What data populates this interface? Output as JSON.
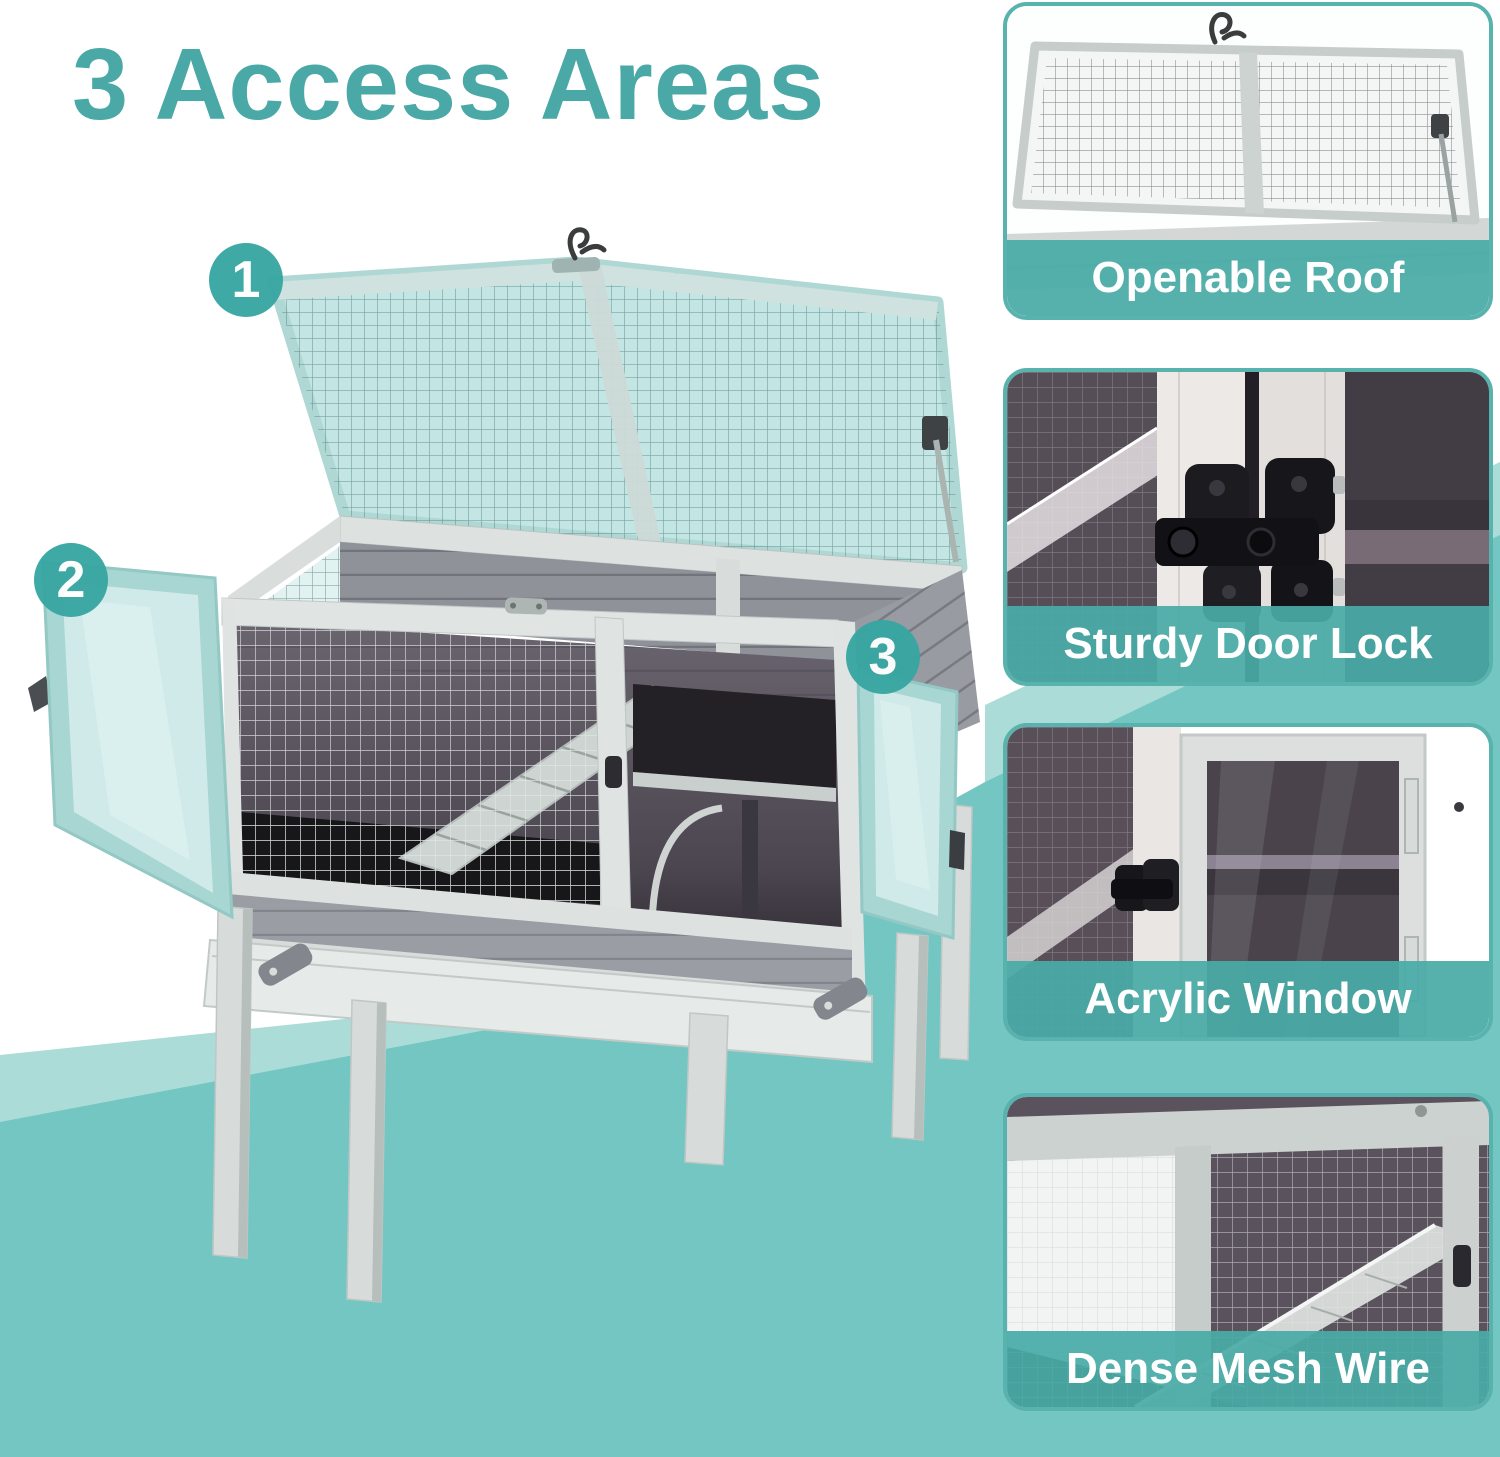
{
  "title": {
    "text": "3 Access Areas"
  },
  "badges": [
    "1",
    "2",
    "3"
  ],
  "features": [
    {
      "label": "Openable Roof"
    },
    {
      "label": "Sturdy Door Lock"
    },
    {
      "label": "Acrylic Window"
    },
    {
      "label": "Dense Mesh Wire"
    }
  ],
  "colors": {
    "accent_teal": "#4aa9a6",
    "badge_teal": "#38a6a2",
    "caption_bar_teal": "#49aba7",
    "background_light_teal": "#abdcd8",
    "background_medium_teal": "#74c6c2",
    "roof_mesh_teal": "#bfe5e2",
    "door_acrylic_teal": "#cdeae8",
    "wood_light_gray": "#dde2e0",
    "wood_dark_gray": "#90929a"
  }
}
